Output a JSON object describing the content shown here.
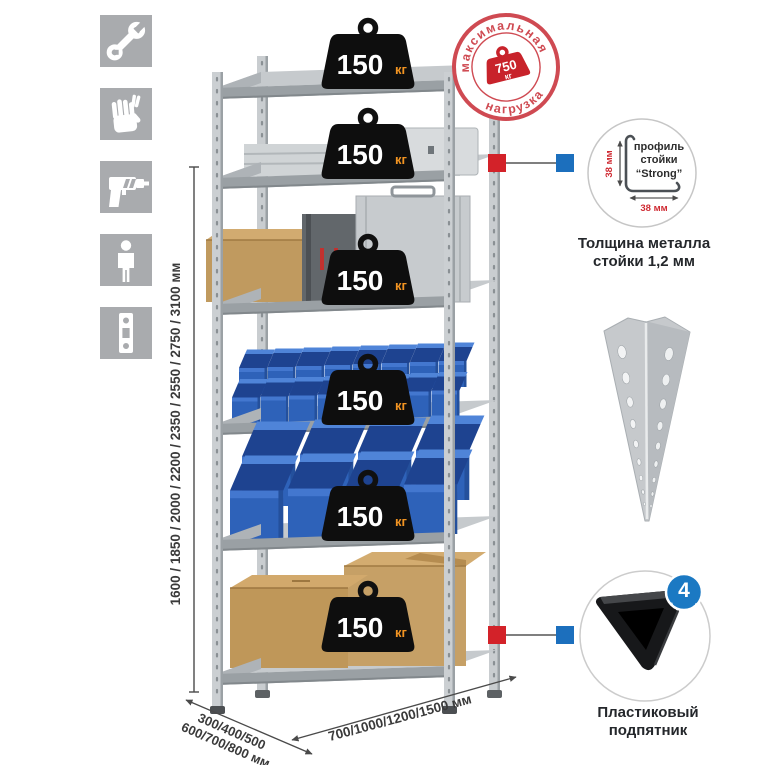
{
  "icons": [
    {
      "name": "wrench-icon"
    },
    {
      "name": "gloves-icon"
    },
    {
      "name": "drill-icon"
    },
    {
      "name": "person-icon"
    },
    {
      "name": "perforated-post-icon"
    }
  ],
  "dimensions": {
    "height": "1600 / 1850 / 2000 / 2200 / 2350 / 2550 / 2750 / 3100 мм",
    "depth_line1": "300/400/500",
    "depth_line2": "600/700/800 мм",
    "width": "700/1000/1200/1500 мм"
  },
  "shelves": [
    {
      "load": "150",
      "unit": "кг"
    },
    {
      "load": "150",
      "unit": "кг"
    },
    {
      "load": "150",
      "unit": "кг"
    },
    {
      "load": "150",
      "unit": "кг"
    },
    {
      "load": "150",
      "unit": "кг"
    },
    {
      "load": "150",
      "unit": "кг"
    }
  ],
  "stamp": {
    "top_text": "максимальная",
    "bottom_text": "нагрузка",
    "value": "750",
    "unit": "кг"
  },
  "profile_callout": {
    "line1": "профиль",
    "line2": "стойки",
    "line3": "“Strong”",
    "dim_vertical": "38 мм",
    "dim_horizontal": "38 мм",
    "caption_line1": "Толщина металла",
    "caption_line2": "стойки 1,2 мм"
  },
  "foot_callout": {
    "count": "4",
    "badge_text": "в комплекте",
    "caption_line1": "Пластиковый",
    "caption_line2": "подпятник"
  },
  "colors": {
    "accent_red": "#d32229",
    "accent_blue": "#1c6fbd",
    "stamp_red": "#cf4a52",
    "badge_black": "#111111",
    "badge_orange": "#f29422",
    "metal_gray": "#c9cdd0",
    "bin_blue": "#2e62b9",
    "cardboard": "#c09759",
    "icon_gray": "#a9abae"
  }
}
